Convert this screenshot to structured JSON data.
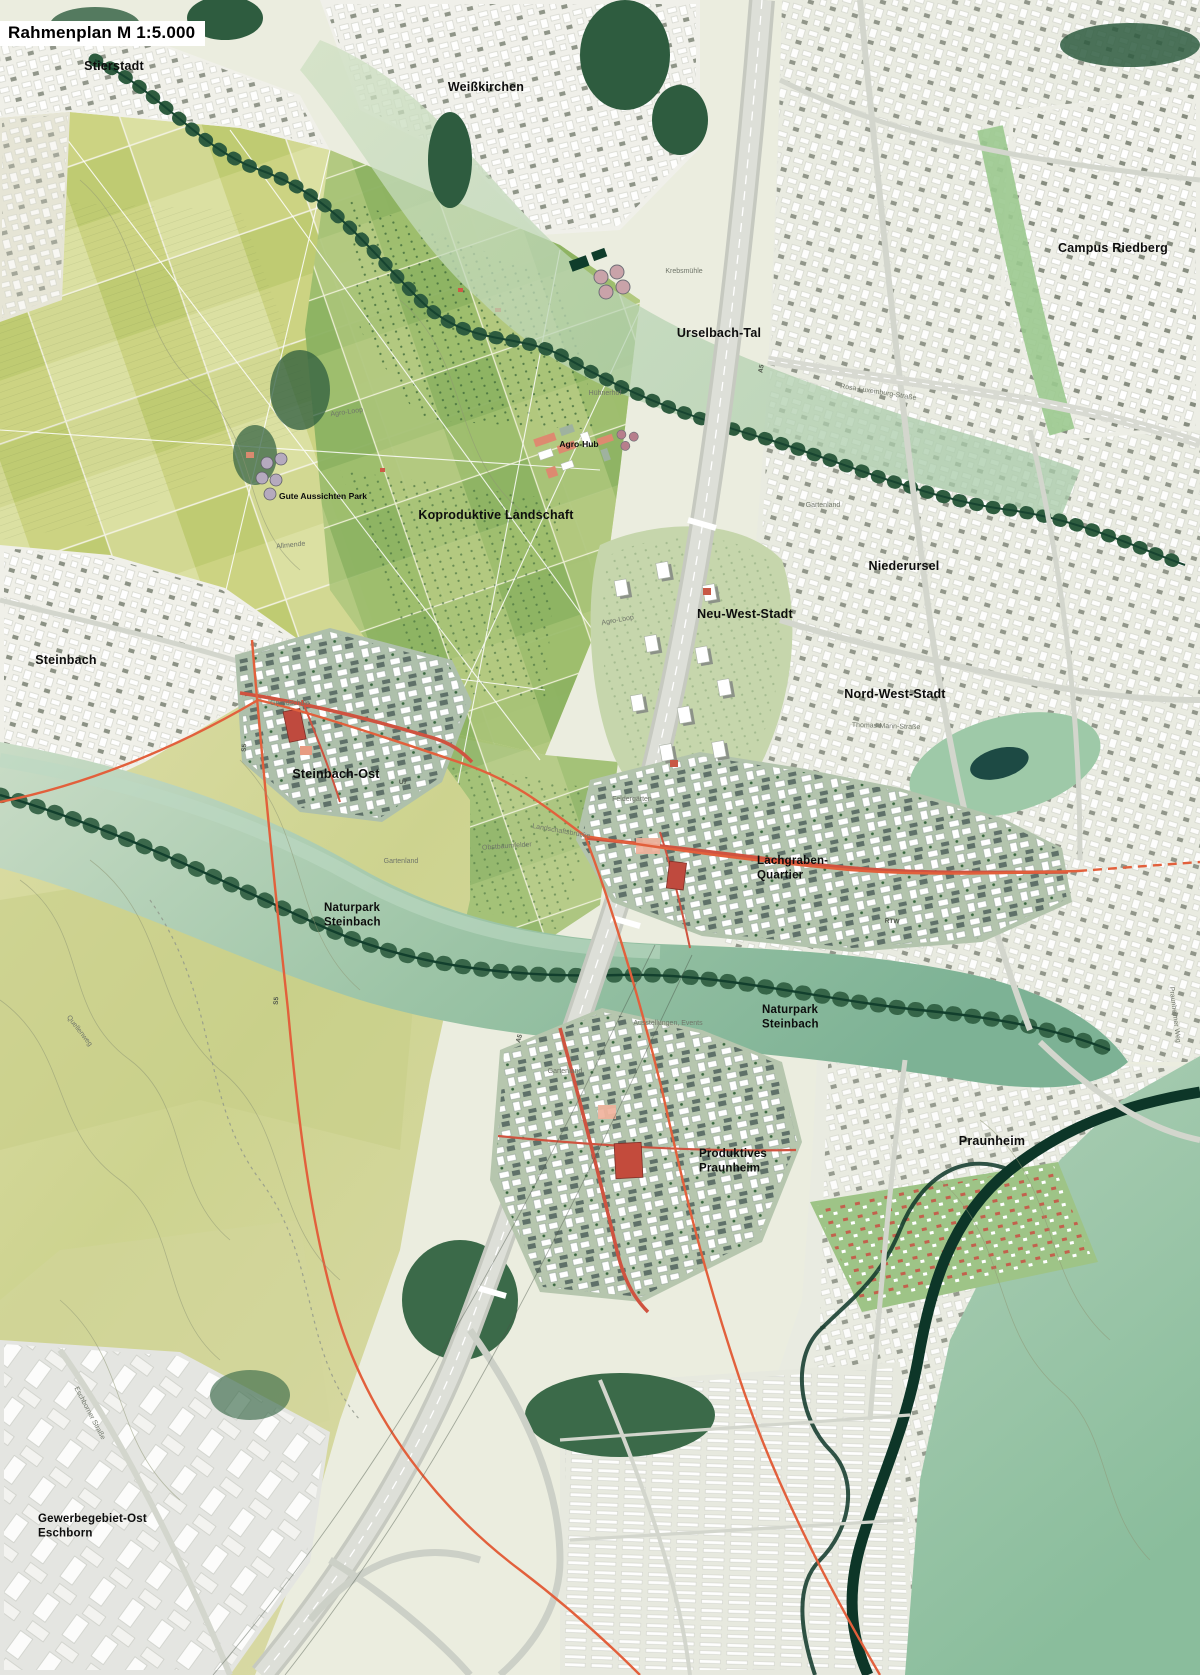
{
  "map": {
    "title": "Rahmenplan M 1:5.000",
    "kind": "urban framework plan (Rahmenplan), scale 1:5000",
    "colors": {
      "field_light": "#d6db9e",
      "field_mid": "#b9cb79",
      "orchard_green": "#8fb468",
      "urban_background": "#e9ebe1",
      "building_white": "#ffffff",
      "building_slate": "#5f7169",
      "forest_dark": "#2e5c3f",
      "floodplain_teal": "#8fbc9e",
      "river_dark": "#0d3628",
      "quarter_base": "#aec0ab",
      "accent_red": "#cf5340",
      "tram_orange": "#e2603c",
      "highway_gray": "#d2d5cd",
      "pond_dark": "#1d4a44"
    },
    "labels": {
      "groups": [
        {
          "name": "district-label",
          "cls": "city",
          "items": [
            {
              "text": "Stierstadt",
              "x": 114,
              "y": 70,
              "anchor": "middle"
            },
            {
              "text": "Weißkirchen",
              "x": 486,
              "y": 91,
              "anchor": "middle"
            },
            {
              "text": "Campus Riedberg",
              "x": 1113,
              "y": 252,
              "anchor": "middle"
            },
            {
              "text": "Urselbach-Tal",
              "x": 719,
              "y": 337,
              "anchor": "middle"
            },
            {
              "text": "Niederursel",
              "x": 904,
              "y": 570,
              "anchor": "middle"
            },
            {
              "text": "Neu-West-Stadt",
              "x": 745,
              "y": 618,
              "anchor": "middle"
            },
            {
              "text": "Nord-West-Stadt",
              "x": 895,
              "y": 698,
              "anchor": "middle"
            },
            {
              "text": "Steinbach",
              "x": 66,
              "y": 664,
              "anchor": "middle"
            },
            {
              "text": "Steinbach-Ost",
              "x": 336,
              "y": 778,
              "anchor": "middle"
            },
            {
              "text": "Koproduktive Landschaft",
              "x": 496,
              "y": 519,
              "anchor": "middle"
            },
            {
              "text": "Praunheim",
              "x": 992,
              "y": 1145,
              "anchor": "middle"
            }
          ]
        },
        {
          "name": "quarter-label",
          "cls": "quarter",
          "items": [
            {
              "lines": [
                "Lachgraben-",
                "Quartier"
              ],
              "x": 757,
              "y": 864,
              "anchor": "start"
            },
            {
              "lines": [
                "Naturpark",
                "Steinbach"
              ],
              "x": 324,
              "y": 911,
              "anchor": "start"
            },
            {
              "lines": [
                "Naturpark",
                "Steinbach"
              ],
              "x": 762,
              "y": 1013,
              "anchor": "start"
            },
            {
              "lines": [
                "Produktives",
                "Praunheim"
              ],
              "x": 699,
              "y": 1157,
              "anchor": "start"
            },
            {
              "lines": [
                "Gewerbegebiet-Ost",
                "Eschborn"
              ],
              "x": 38,
              "y": 1522,
              "anchor": "start"
            }
          ]
        },
        {
          "name": "poi-label",
          "cls": "poi",
          "items": [
            {
              "text": "Gute Aussichten Park",
              "x": 323,
              "y": 499,
              "anchor": "middle"
            },
            {
              "text": "Agro-Hub",
              "x": 579,
              "y": 447,
              "anchor": "middle"
            }
          ]
        },
        {
          "name": "minor-label",
          "cls": "faint",
          "items": [
            {
              "text": "Agro-Loop",
              "x": 347,
              "y": 414,
              "anchor": "middle",
              "rot": -8
            },
            {
              "text": "Agro-Loop",
              "x": 618,
              "y": 622,
              "anchor": "middle",
              "rot": -10
            },
            {
              "text": "Allmende",
              "x": 291,
              "y": 547,
              "anchor": "middle",
              "rot": -6
            },
            {
              "text": "Hühnerhof",
              "x": 605,
              "y": 395,
              "anchor": "middle"
            },
            {
              "text": "Krebsmühle",
              "x": 684,
              "y": 273,
              "anchor": "middle"
            },
            {
              "text": "Gartenland",
              "x": 823,
              "y": 507,
              "anchor": "middle"
            },
            {
              "text": "Gartenland",
              "x": 401,
              "y": 863,
              "anchor": "middle"
            },
            {
              "text": "Gartenland",
              "x": 565,
              "y": 1073,
              "anchor": "middle"
            },
            {
              "text": "Obstbaumfelder",
              "x": 507,
              "y": 848,
              "anchor": "middle",
              "rot": -4
            },
            {
              "text": "Landschaftsbrücke",
              "x": 561,
              "y": 833,
              "anchor": "middle",
              "rot": 10
            },
            {
              "text": "Feldergärten",
              "x": 632,
              "y": 801,
              "anchor": "middle"
            },
            {
              "text": "Grundschule",
              "x": 290,
              "y": 705,
              "anchor": "middle"
            },
            {
              "text": "Ausstellungen, Events",
              "x": 668,
              "y": 1025,
              "anchor": "middle"
            },
            {
              "text": "Thomas-Mann-Straße",
              "x": 886,
              "y": 728,
              "anchor": "middle",
              "rot": 2
            },
            {
              "text": "Rosa-Luxemburg-Straße",
              "x": 878,
              "y": 394,
              "anchor": "middle",
              "rot": 9
            },
            {
              "text": "Eschborner Straße",
              "x": 88,
              "y": 1414,
              "anchor": "middle",
              "rot": 62
            },
            {
              "text": "Praunheimer Weg",
              "x": 1173,
              "y": 1015,
              "anchor": "middle",
              "rot": 83
            },
            {
              "text": "Quellenweg",
              "x": 78,
              "y": 1032,
              "anchor": "middle",
              "rot": 52
            }
          ]
        },
        {
          "name": "transit-label",
          "cls": "transit",
          "items": [
            {
              "text": "A5",
              "x": 763,
              "y": 369,
              "anchor": "middle",
              "rot": -80
            },
            {
              "text": "A5",
              "x": 521,
              "y": 1039,
              "anchor": "middle",
              "rot": -73
            },
            {
              "text": "S5",
              "x": 278,
              "y": 1001,
              "anchor": "middle",
              "rot": -85
            },
            {
              "text": "S5",
              "x": 246,
              "y": 748,
              "anchor": "middle",
              "rot": -85
            },
            {
              "text": "RTW",
              "x": 892,
              "y": 923,
              "anchor": "middle",
              "rot": 3
            },
            {
              "text": "U7",
              "x": 403,
              "y": 784,
              "anchor": "middle"
            }
          ]
        }
      ]
    }
  }
}
